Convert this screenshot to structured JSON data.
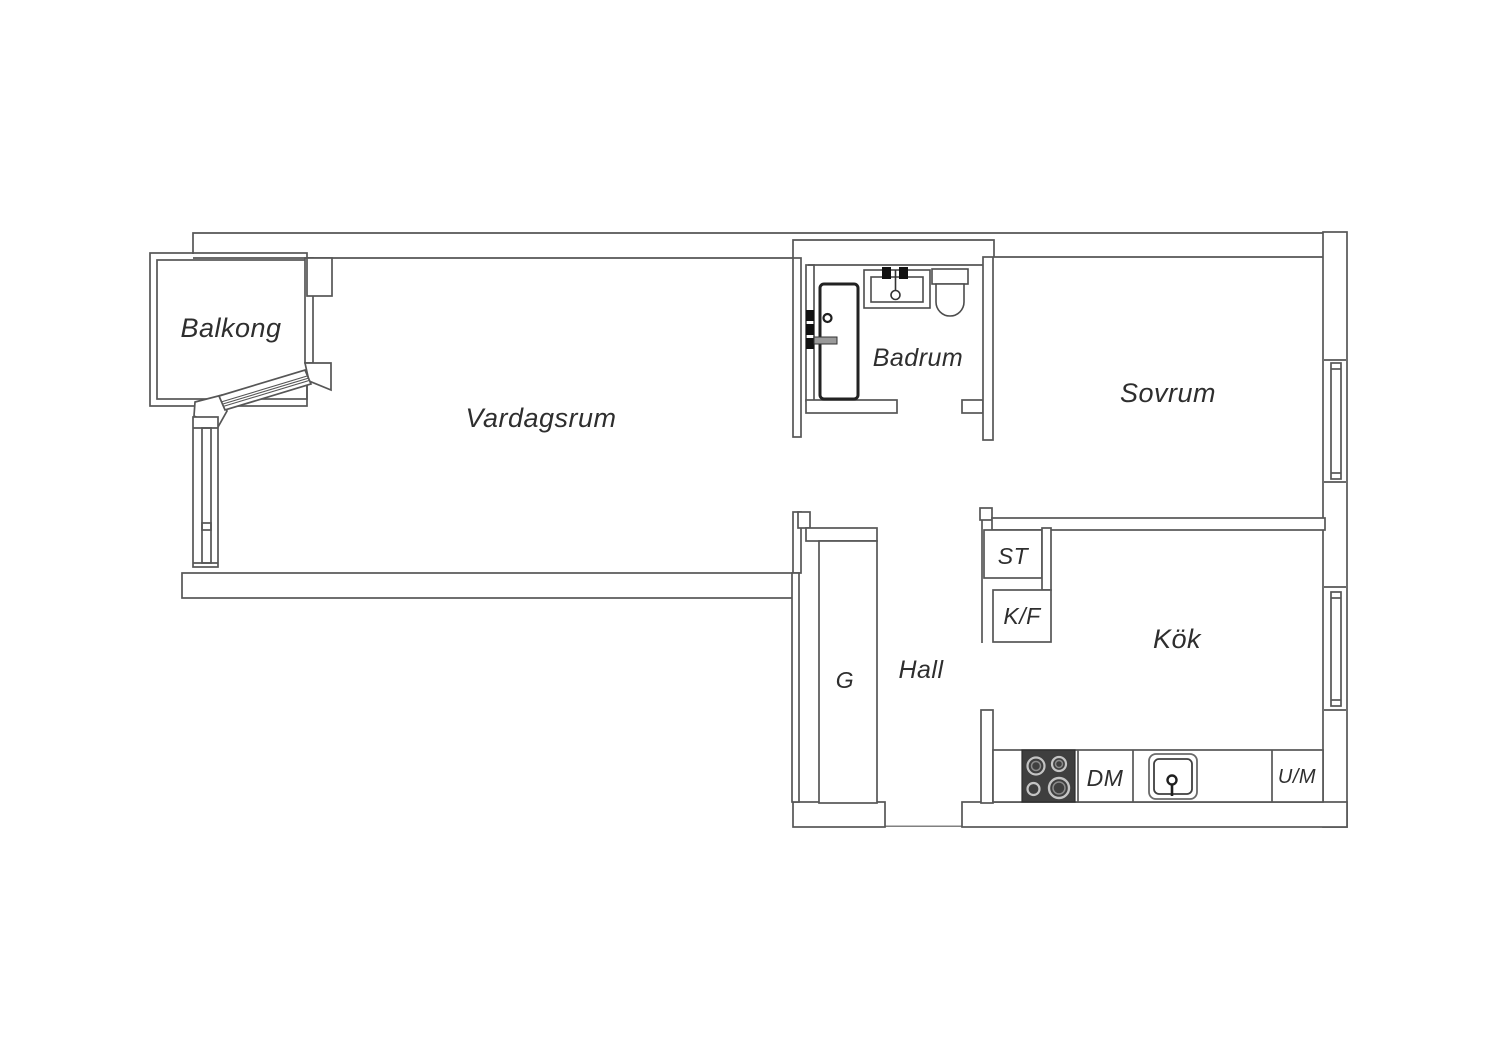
{
  "rooms": {
    "balcony": {
      "label": "Balkong"
    },
    "living_room": {
      "label": "Vardagsrum"
    },
    "bathroom": {
      "label": "Badrum"
    },
    "bedroom": {
      "label": "Sovrum"
    },
    "kitchen": {
      "label": "Kök"
    },
    "hall": {
      "label": "Hall"
    }
  },
  "fixtures": {
    "closet": {
      "label": "ST"
    },
    "fridge_freezer": {
      "label": "K/F"
    },
    "wardrobe": {
      "label": "G"
    },
    "dishwasher": {
      "label": "DM"
    },
    "washing_machine": {
      "label": "U/M"
    }
  },
  "colors": {
    "background": "#ffffff",
    "wall_line": "#565656",
    "text": "#2e2e2e",
    "stove_dark": "#3f3f3f",
    "burner_ring": "#c4c4c4"
  }
}
